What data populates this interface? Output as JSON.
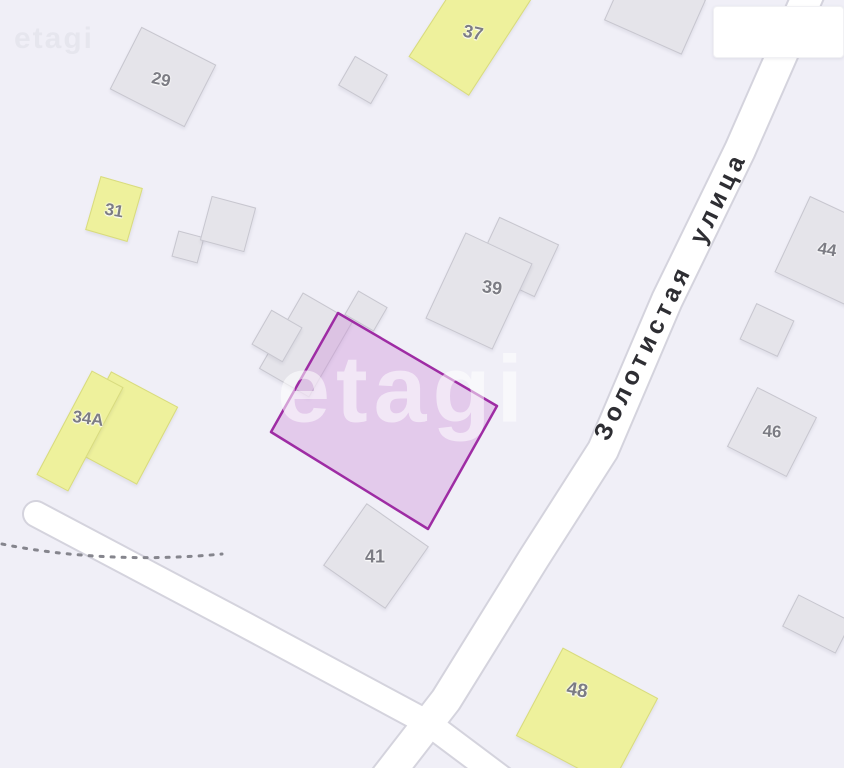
{
  "street": {
    "name": "Золотистая улица"
  },
  "watermark": {
    "text": "etagi"
  },
  "info_box": {
    "text": ""
  },
  "colors": {
    "background": "#f0eff7",
    "road_fill": "#ffffff",
    "road_casing": "#d4d3dd",
    "building_gray": "#e5e4ea",
    "building_gray_border": "#c7c6cf",
    "building_yellow": "#eef19c",
    "building_yellow_border": "#d8db7e",
    "plot_border": "#9e2ca4",
    "plot_fill": "rgba(206,142,216,0.38)",
    "building_label_color": "#7c7c84",
    "street_label_color": "#2e2e33",
    "dotted_line_color": "#85858d"
  },
  "buildings": [
    {
      "label": "29",
      "type": "gray"
    },
    {
      "label": "37",
      "type": "yellow"
    },
    {
      "label": "31",
      "type": "yellow"
    },
    {
      "label": "39",
      "type": "gray"
    },
    {
      "label": "34A",
      "type": "yellow"
    },
    {
      "label": "41",
      "type": "gray"
    },
    {
      "label": "44",
      "type": "gray"
    },
    {
      "label": "46",
      "type": "gray"
    },
    {
      "label": "48",
      "type": "yellow"
    }
  ],
  "highlighted_plot": {
    "points": "338,313 497,406 428,529 271,432"
  },
  "roads": {
    "main_street_path": "M 812 -14 L 740 150 L 667 300 L 603 450 L 534 558 L 446 700 L 384 780",
    "side_road_path": "M 36 514 L 240 622 L 428 723 L 520 792",
    "dotted_boundary_path": "M 2 544 C 70 558 150 561 222 554"
  }
}
